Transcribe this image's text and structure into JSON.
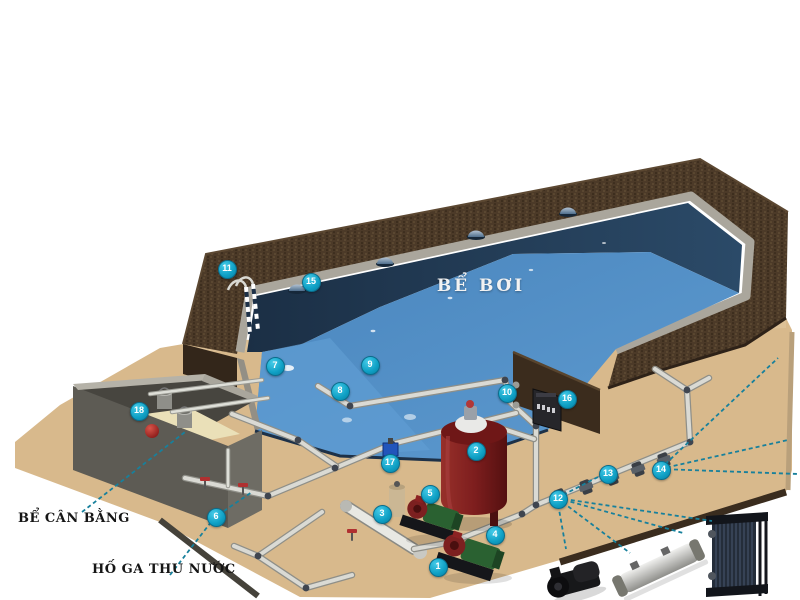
{
  "diagram": {
    "type": "swimming-pool-filtration-system-cutaway"
  },
  "labels": {
    "pool": "BỂ BƠI",
    "balance_tank": "BỂ CÂN BẰNG",
    "collection_pit": "HỐ GA THU NƯỚC"
  },
  "markers": [
    {
      "n": "1",
      "x": 437,
      "y": 566
    },
    {
      "n": "2",
      "x": 475,
      "y": 450
    },
    {
      "n": "3",
      "x": 381,
      "y": 513
    },
    {
      "n": "4",
      "x": 494,
      "y": 534
    },
    {
      "n": "5",
      "x": 429,
      "y": 493
    },
    {
      "n": "6",
      "x": 215,
      "y": 516
    },
    {
      "n": "7",
      "x": 274,
      "y": 365
    },
    {
      "n": "8",
      "x": 339,
      "y": 390
    },
    {
      "n": "9",
      "x": 369,
      "y": 364
    },
    {
      "n": "10",
      "x": 506,
      "y": 392
    },
    {
      "n": "11",
      "x": 226,
      "y": 268
    },
    {
      "n": "12",
      "x": 557,
      "y": 498
    },
    {
      "n": "13",
      "x": 607,
      "y": 473
    },
    {
      "n": "14",
      "x": 660,
      "y": 469
    },
    {
      "n": "15",
      "x": 310,
      "y": 281
    },
    {
      "n": "16",
      "x": 566,
      "y": 398
    },
    {
      "n": "17",
      "x": 389,
      "y": 462
    },
    {
      "n": "18",
      "x": 138,
      "y": 410
    }
  ],
  "colors": {
    "marker_bg": "#0e9fc4",
    "marker_text": "#ffffff",
    "leader": "#17809c",
    "water_deep": "#22394f",
    "water_shallow": "#4f8dc5",
    "deck_brown": "#4b3a27",
    "sand": "#d8b98c",
    "filter_tank_red": "#7e1e1e",
    "label_text": "#151515",
    "pool_label": "#f2f2f2"
  }
}
